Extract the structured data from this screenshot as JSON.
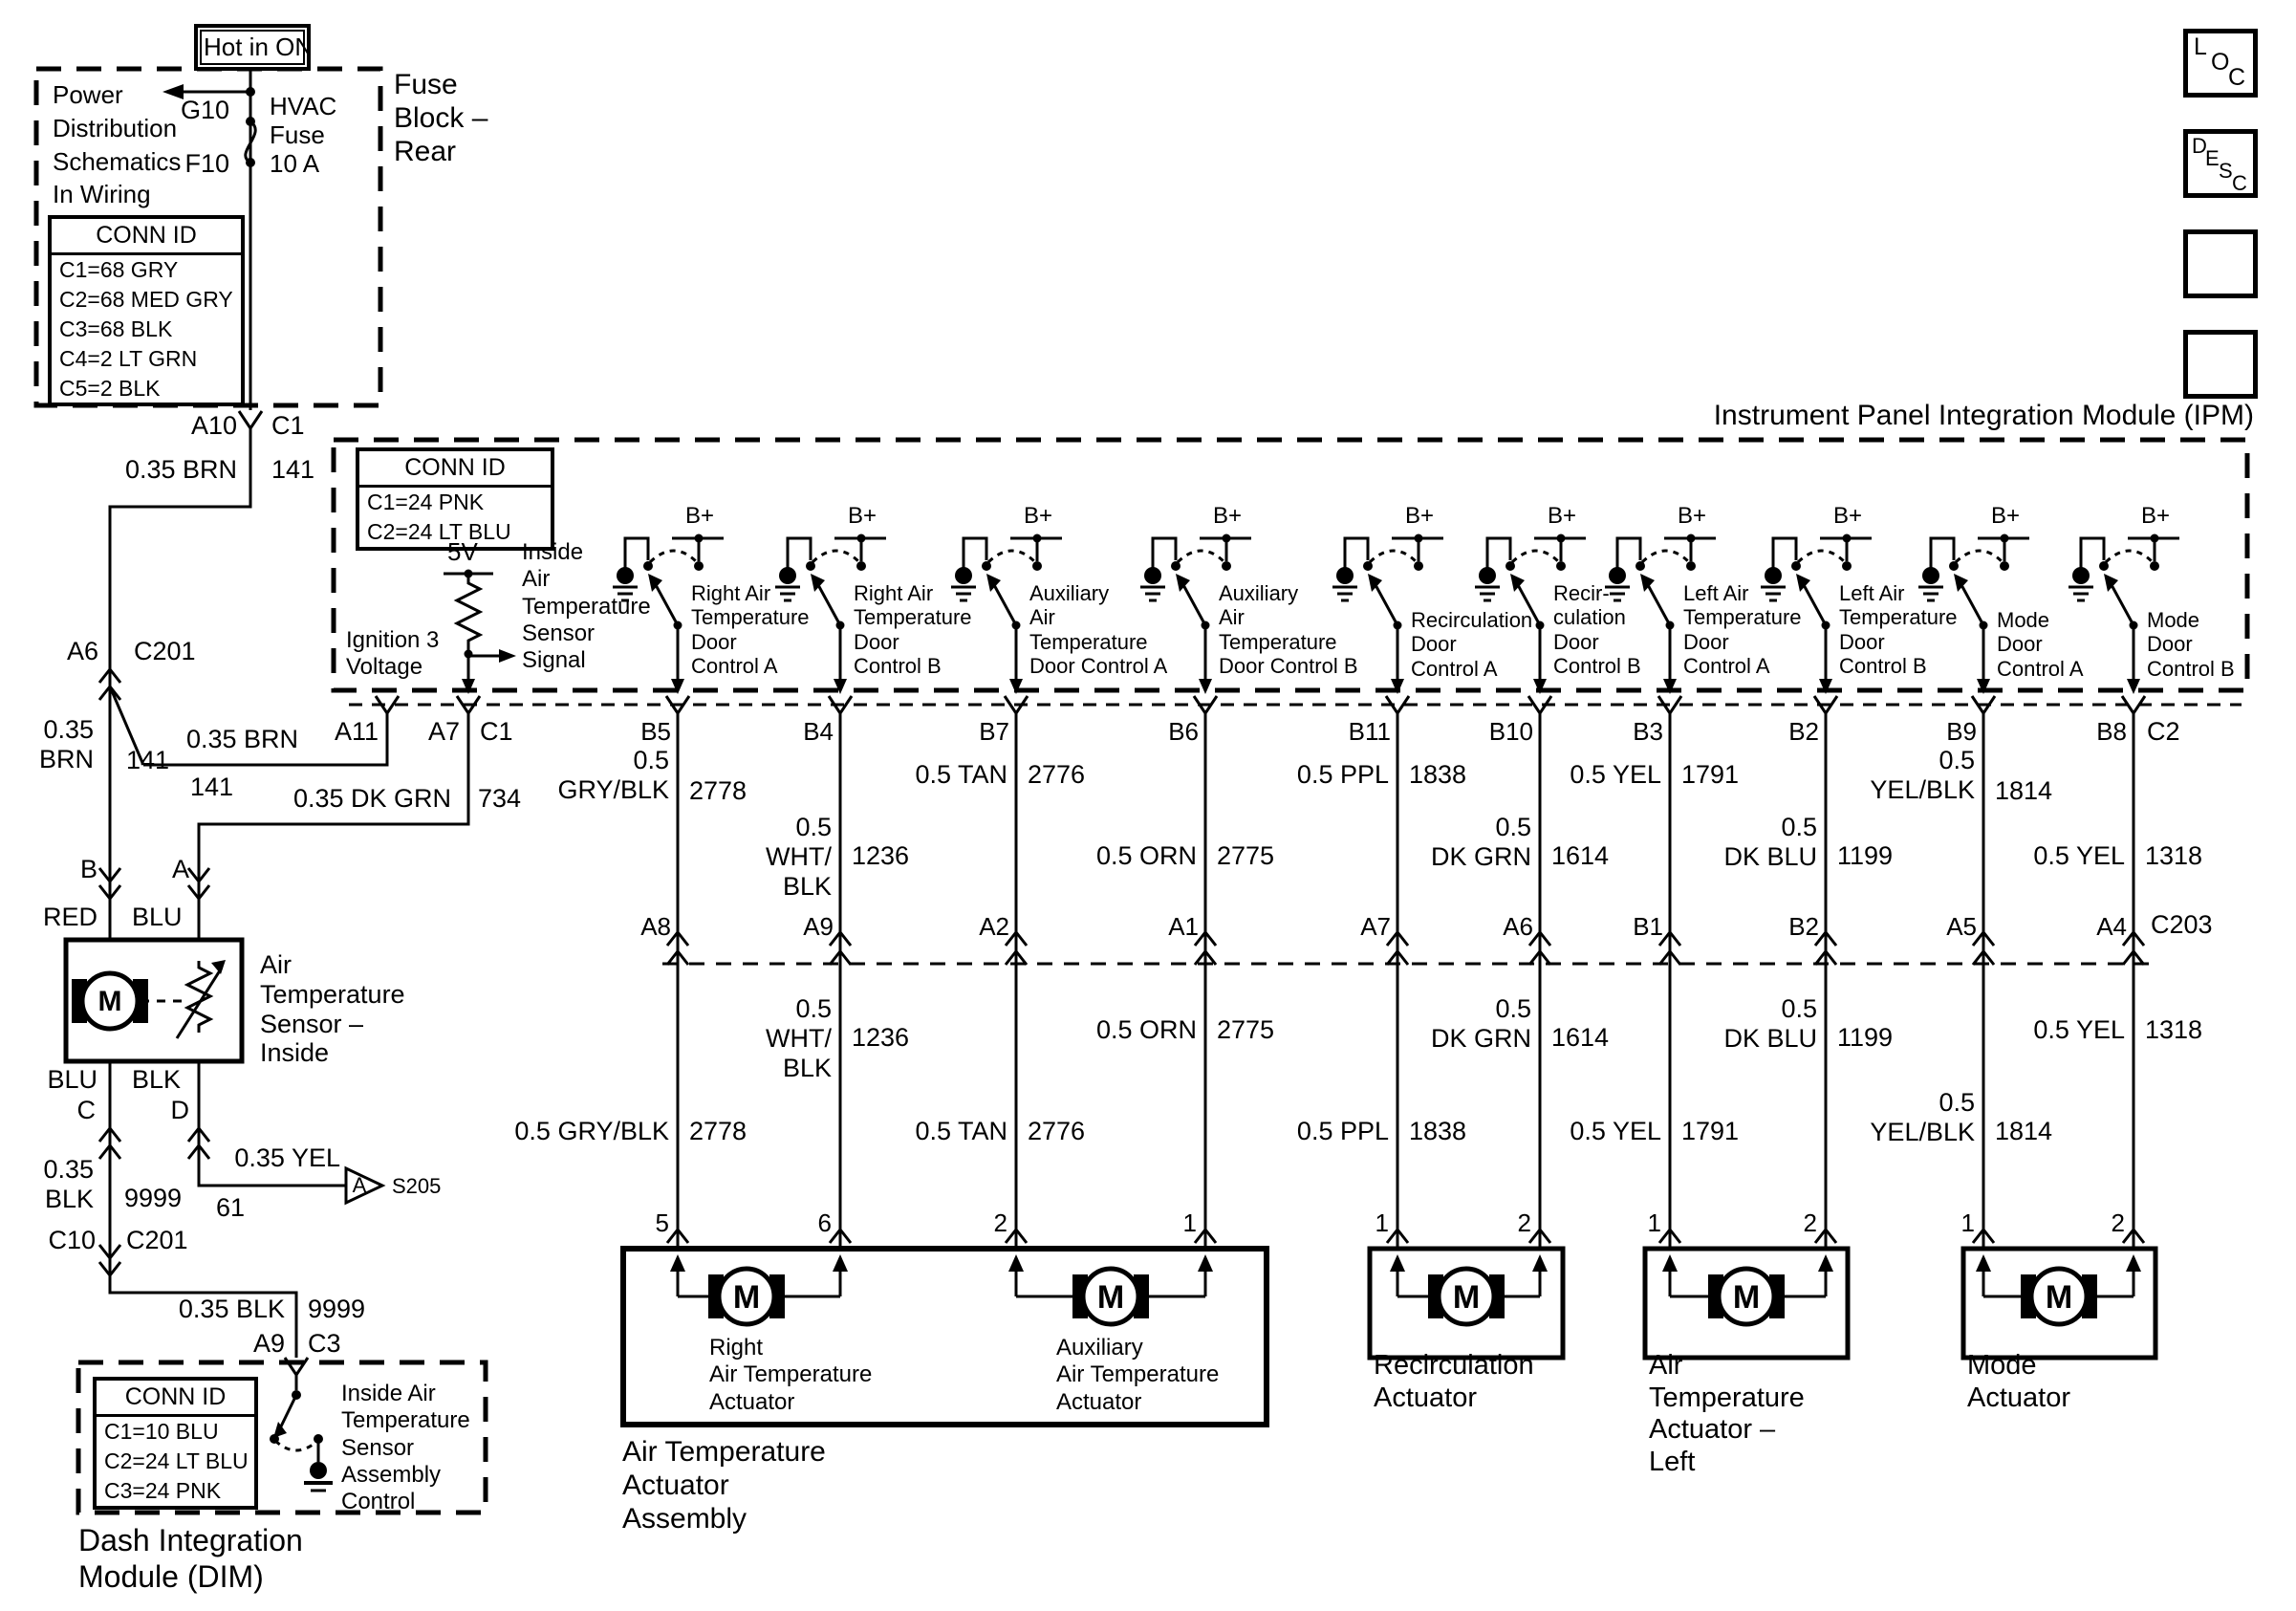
{
  "diagram": {
    "hot_in_on": "Hot in ON",
    "fuse_block": {
      "title": "Fuse\nBlock –\nRear",
      "note": "Power\nDistribution\nSchematics\nIn Wiring\nSystems",
      "g10": "G10",
      "f10": "F10",
      "fuse": "HVAC\nFuse\n10 A",
      "conn_id": {
        "header": "CONN ID",
        "rows": [
          "C1=68 GRY",
          "C2=68 MED GRY",
          "C3=68 BLK",
          "C4=2 LT GRN",
          "C5=2 BLK"
        ]
      }
    },
    "left_branch": {
      "a10": "A10",
      "c1": "C1",
      "spec_brn": "0.35 BRN",
      "ckt_141": "141",
      "a6": "A6",
      "c201": "C201",
      "spec_brn_2": "0.35\nBRN",
      "ckt_141_2": "141",
      "spec_brn_3": "0.35 BRN",
      "ckt_141_3": "141",
      "spec_dkgrn": "0.35 DK GRN",
      "ckt_734": "734",
      "pin_b": "B",
      "pin_a": "A",
      "red": "RED",
      "blu": "BLU",
      "sensor_title": "Air\nTemperature\nSensor –\nInside",
      "blu_2": "BLU",
      "blk": "BLK",
      "pin_c": "C",
      "pin_d": "D",
      "spec_yel": "0.35 YEL",
      "ckt_61": "61",
      "splice_a": "A",
      "s205": "S205",
      "spec_blk": "0.35\nBLK",
      "ckt_9999": "9999",
      "c10": "C10",
      "c201_2": "C201",
      "spec_blk_2": "0.35 BLK",
      "ckt_9999_2": "9999",
      "a9": "A9",
      "c3": "C3"
    },
    "dim": {
      "title": "Dash Integration\nModule (DIM)",
      "conn_id": {
        "header": "CONN ID",
        "rows": [
          "C1=10 BLU",
          "C2=24 LT BLU",
          "C3=24 PNK"
        ]
      },
      "switch_label": "Inside Air\nTemperature\nSensor\nAssembly\nControl"
    },
    "ipm": {
      "title": "Instrument Panel Integration Module (IPM)",
      "conn_id": {
        "header": "CONN ID",
        "rows": [
          "C1=24 PNK",
          "C2=24 LT BLU"
        ]
      },
      "ign": "Ignition 3\nVoltage",
      "fivev": "5V",
      "signal": "Inside\nAir\nTemperature\nSensor\nSignal",
      "a11": "A11",
      "a7": "A7",
      "c1": "C1",
      "c2": "C2",
      "bplus": "B+",
      "controls": [
        "Right Air\nTemperature\nDoor\nControl A",
        "Right Air\nTemperature\nDoor\nControl B",
        "Auxiliary\nAir\nTemperature\nDoor Control A",
        "Auxiliary\nAir\nTemperature\nDoor Control B",
        "Recirculation\nDoor\nControl A",
        "Recir-\nculation\nDoor\nControl B",
        "Left Air\nTemperature\nDoor\nControl A",
        "Left Air\nTemperature\nDoor\nControl B",
        "Mode\nDoor\nControl A",
        "Mode\nDoor\nControl B"
      ]
    },
    "c203": "C203",
    "wires": [
      {
        "pin_ipm": "B5",
        "pin_c203": "A8",
        "pin_act": "5",
        "spec_upper": "0.5\nGRY/BLK",
        "ckt_upper": "2778",
        "spec_lower": "0.5 GRY/BLK",
        "ckt_lower": "2778"
      },
      {
        "pin_ipm": "B4",
        "pin_c203": "A9",
        "pin_act": "6",
        "spec_upper": "0.5\nWHT/\nBLK",
        "ckt_upper": "1236",
        "spec_lower": "0.5\nWHT/\nBLK",
        "ckt_lower": "1236"
      },
      {
        "pin_ipm": "B7",
        "pin_c203": "A2",
        "pin_act": "2",
        "spec_upper": "0.5 TAN",
        "ckt_upper": "2776",
        "spec_lower": "0.5 TAN",
        "ckt_lower": "2776"
      },
      {
        "pin_ipm": "B6",
        "pin_c203": "A1",
        "pin_act": "1",
        "spec_upper": "0.5 ORN",
        "ckt_upper": "2775",
        "spec_lower": "0.5 ORN",
        "ckt_lower": "2775"
      },
      {
        "pin_ipm": "B11",
        "pin_c203": "A7",
        "pin_act": "1",
        "spec_upper": "0.5 PPL",
        "ckt_upper": "1838",
        "spec_lower": "0.5 PPL",
        "ckt_lower": "1838"
      },
      {
        "pin_ipm": "B10",
        "pin_c203": "A6",
        "pin_act": "2",
        "spec_upper": "0.5\nDK GRN",
        "ckt_upper": "1614",
        "spec_lower": "0.5\nDK GRN",
        "ckt_lower": "1614"
      },
      {
        "pin_ipm": "B3",
        "pin_c203": "B1",
        "pin_act": "1",
        "spec_upper": "0.5 YEL",
        "ckt_upper": "1791",
        "spec_lower": "0.5 YEL",
        "ckt_lower": "1791"
      },
      {
        "pin_ipm": "B2",
        "pin_c203": "B2",
        "pin_act": "2",
        "spec_upper": "0.5\nDK BLU",
        "ckt_upper": "1199",
        "spec_lower": "0.5\nDK BLU",
        "ckt_lower": "1199"
      },
      {
        "pin_ipm": "B9",
        "pin_c203": "A5",
        "pin_act": "1",
        "spec_upper": "0.5\nYEL/BLK",
        "ckt_upper": "1814",
        "spec_lower": "0.5\nYEL/BLK",
        "ckt_lower": "1814"
      },
      {
        "pin_ipm": "B8",
        "pin_c203": "A4",
        "pin_act": "2",
        "spec_upper": "0.5 YEL",
        "ckt_upper": "1318",
        "spec_lower": "0.5 YEL",
        "ckt_lower": "1318"
      }
    ],
    "actuators": {
      "motor": "M",
      "assembly": "Air Temperature\nActuator\nAssembly",
      "right": "Right\nAir Temperature\nActuator",
      "aux": "Auxiliary\nAir Temperature\nActuator",
      "recirc": "Recirculation\nActuator",
      "left": "Air\nTemperature\nActuator –\nLeft",
      "mode": "Mode\nActuator"
    },
    "nav": {
      "loc": [
        "L",
        "O",
        "C"
      ],
      "desc": [
        "D",
        "E",
        "S",
        "C"
      ]
    }
  }
}
